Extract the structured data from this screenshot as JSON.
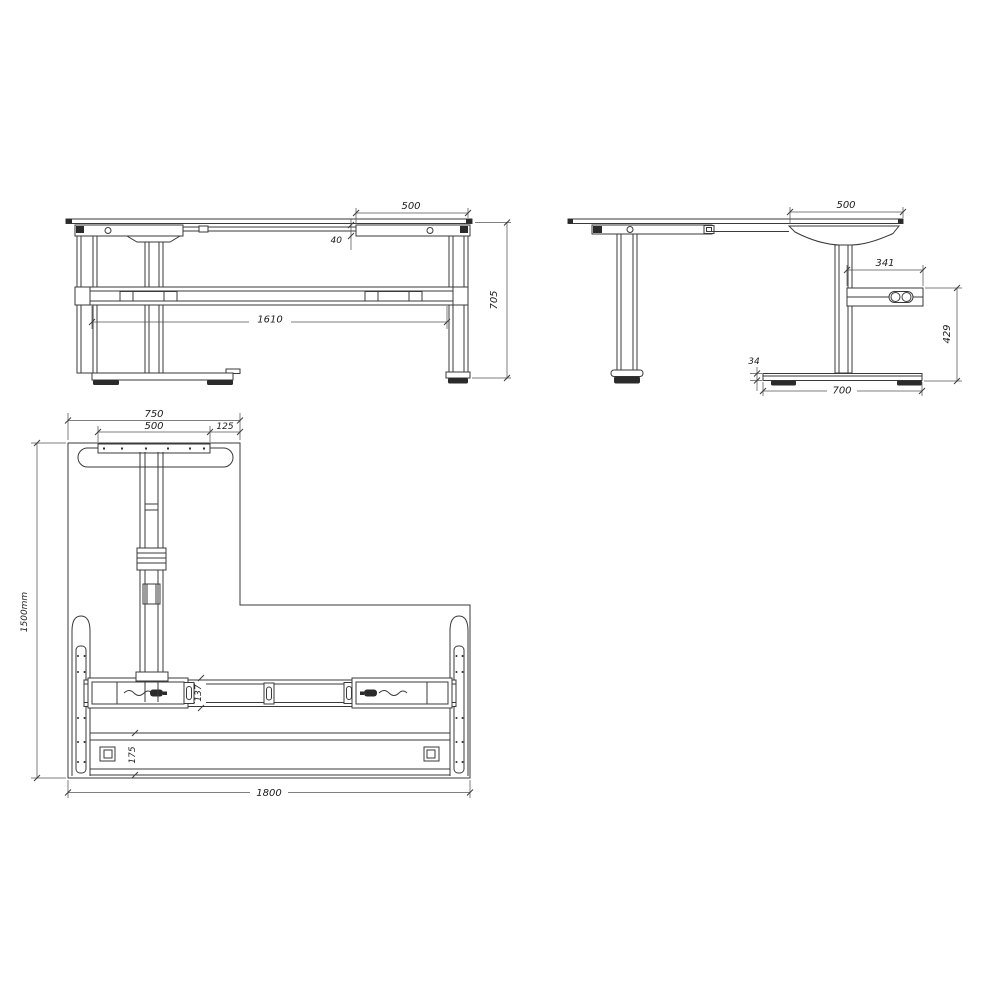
{
  "views": {
    "front": {
      "dims": {
        "top_overhang": "500",
        "frame_offset": "40",
        "leg_span": "1610",
        "height": "705"
      }
    },
    "side": {
      "dims": {
        "top_overhang": "500",
        "control_box_width": "341",
        "control_box_floor_height": "429",
        "foot_height": "34",
        "foot_depth": "700"
      }
    },
    "plan": {
      "dims": {
        "foot_plate_width": "750",
        "bracket_width": "500",
        "edge_margin": "125",
        "depth": "1500mm",
        "beam_width": "137",
        "rear_beam_width": "175",
        "width": "1800"
      }
    }
  },
  "colors": {
    "line": "#3a3a3a",
    "dark_fill": "#2b2b2b",
    "background": "#ffffff"
  }
}
